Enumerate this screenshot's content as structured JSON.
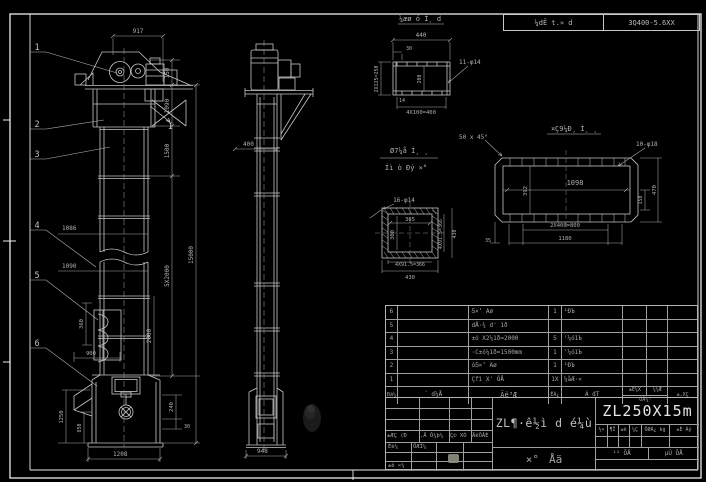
{
  "header": {
    "left_cell": "¼dÊ t.» d",
    "right_cell": "3Q400-5.6XX"
  },
  "front_view": {
    "callouts": [
      "1",
      "2",
      "3",
      "4",
      "5",
      "6"
    ],
    "section_mark": "I",
    "dims": {
      "head_width": "917",
      "head_h": "150",
      "upper1": "1090",
      "upper2": "1500",
      "sections": "5X2000",
      "total_h": "15000",
      "lower": "2000",
      "boot1": "240",
      "boot2": "30",
      "w1": "1086",
      "w2": "1090",
      "bucket_h": "360",
      "boot_w": "900",
      "pit1": "1250",
      "pit2": "850",
      "base_w": "1208"
    }
  },
  "side_view": {
    "dims": {
      "casing_w": "400",
      "base_w": "948"
    }
  },
  "detail_a": {
    "title": "¼æø ó Ì¸ d",
    "dims": {
      "w": "440",
      "offset": "30",
      "holes": "11-φ14",
      "pitch": "4X100=400",
      "side": "2X125=250",
      "inner": "200",
      "t": "14"
    }
  },
  "detail_b": {
    "title_1": "Ø7¼å Ì¸ ¸",
    "title_2": "Íì ò Ðý ×°",
    "holes": "16-φ14",
    "dims": {
      "inner_w": "365",
      "inner_h": "300",
      "pitch_r": "4X91.5=366",
      "out_r": "430",
      "pitch_b": "4X91.5=366",
      "out_b": "430"
    }
  },
  "detail_c": {
    "title": "¤Ç9¼Ð¸ Ì¸ ¸",
    "chamfer": "50 x 45°",
    "holes": "10-φ18",
    "dims": {
      "inner_w": "1098",
      "inner_h": "392",
      "right_1": "150",
      "right_2": "470",
      "pitch": "2X400=800",
      "out_w": "1180",
      "edge": "35"
    }
  },
  "parts_table": {
    "headers": {
      "seq": "Ðã¼",
      "code": "´ d¼Å",
      "name": "Ãë³Æ",
      "qty": "ÊÁ¿",
      "material": "Á dT",
      "w_top1": "±Ê¼X",
      "w_top2": "¼¼Æ",
      "w_bottom": "ÓÅ¼·",
      "remark": "±,XÇ"
    },
    "rows": [
      {
        "seq": "6",
        "code": "",
        "name": "Ƽ×ʼ Aø",
        "qty": "1",
        "material": "¹ÐЪ"
      },
      {
        "seq": "5",
        "code": "",
        "name": "dÅ·¾ d' 1ð",
        "qty": "",
        "material": ""
      },
      {
        "seq": "4",
        "code": "",
        "name": "±ó X2¼1ð=2000",
        "qty": "5",
        "material": "'¼ó1Ъ"
      },
      {
        "seq": "3",
        "code": "",
        "name": "·C±ó¼1ð=1500mm",
        "qty": "1",
        "material": "'¼ó1Ъ"
      },
      {
        "seq": "2",
        "code": "",
        "name": "óƼ×ʼ Aø",
        "qty": "1",
        "material": "¹ÐЪ"
      },
      {
        "seq": "1",
        "code": "",
        "name": "Çfì X' ÓÅ",
        "qty": "1X",
        "material": "¼åÆ·«"
      }
    ]
  },
  "title_block": {
    "rev_labels": [
      "±ÆÇ (Ð",
      ",Ä Ô¼þ¼",
      "Ç© XÓ",
      "ÄêÔÂÈ"
    ],
    "sig_row1_a": "Éè¼",
    "sig_row1_b": "ÖÆÍ¼",
    "sig_row3_a": "±ê ×¼",
    "title_main": "ZL¶·ê½ì d é¼ù",
    "title_sub_1": "×°",
    "title_sub_2": "Åä",
    "model": "ZL250X15m",
    "stage_cells": [
      "½×",
      "¶Î",
      "±ê",
      "¼Ç"
    ],
    "weight_label": "ÖØÁ¿ kg",
    "scale_label": "±È Àý",
    "sheets_left": "¹² ÕÅ",
    "sheets_right": "µÚ ÕÅ"
  }
}
